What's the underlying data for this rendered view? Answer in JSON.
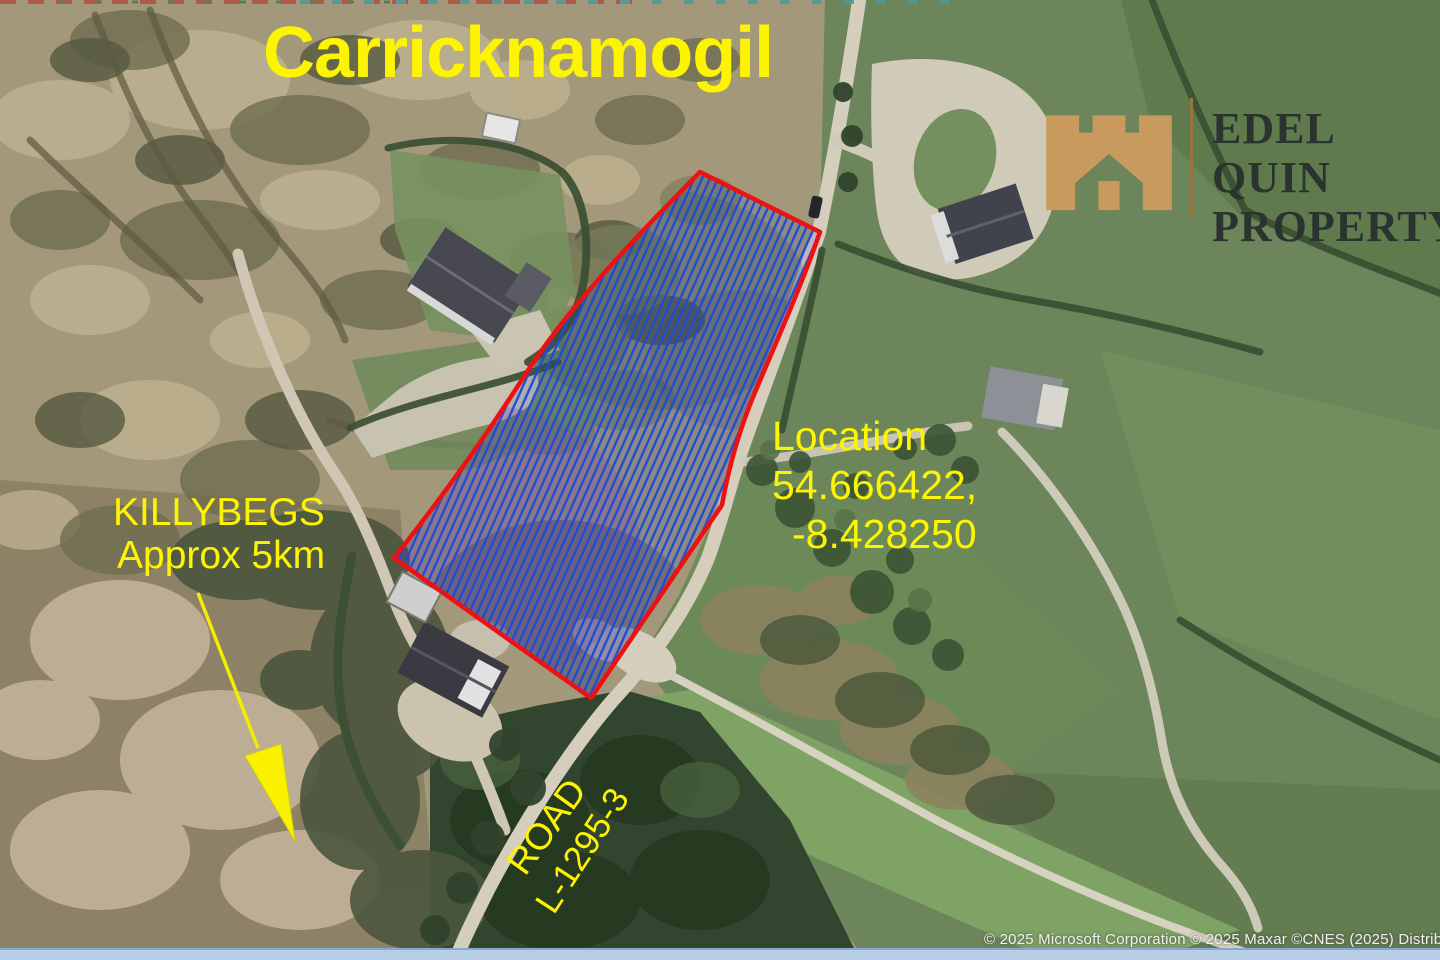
{
  "annotations": {
    "title": "Carricknamogil",
    "location": {
      "label": "Location",
      "line1": "54.666422,",
      "line2": "-8.428250"
    },
    "destination": {
      "name": "KILLYBEGS",
      "distance": "Approx 5km"
    },
    "road": {
      "name": "ROAD",
      "code": "L-1295-3"
    }
  },
  "logo": {
    "line1": "EDEL QUIN",
    "line2": "PROPERTY"
  },
  "attribution": "© 2025 Microsoft Corporation © 2025 Maxar ©CNES (2025) Distrib",
  "parcel": {
    "outline_color": "#ec1212",
    "hatch_color": "#1c4bd4",
    "coordinates": "54.666422, -8.428250"
  },
  "colors": {
    "annotation_yellow": "#fcf400",
    "logo_gold": "#c89a5e",
    "logo_text": "#2b332e",
    "bottom_bar": "#b8cee6"
  }
}
